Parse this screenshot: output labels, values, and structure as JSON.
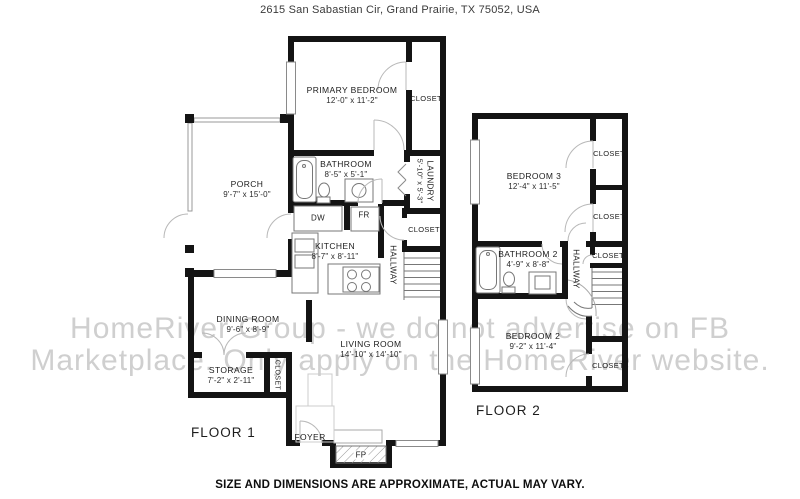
{
  "address": "2615 San Sabastian Cir, Grand Prairie, TX 75052, USA",
  "disclaimer": "SIZE AND DIMENSIONS ARE APPROXIMATE, ACTUAL MAY VARY.",
  "watermark": {
    "line1": "HomeRiver Group - we do not advertise on FB",
    "line2": "Marketplace. Only apply on the HomeRiver website."
  },
  "floor1": {
    "label": "FLOOR 1",
    "rooms": {
      "primary_bedroom": {
        "name": "PRIMARY BEDROOM",
        "dims": "12'-0\" x 11'-2\""
      },
      "primary_closet": {
        "name": "CLOSET"
      },
      "bathroom": {
        "name": "BATHROOM",
        "dims": "8'-5\" x 5'-1\""
      },
      "laundry": {
        "name": "LAUNDRY",
        "dims": "5'-10\" x 5'-3\""
      },
      "kitchen": {
        "name": "KITCHEN",
        "dims": "8'-7\" x 8'-11\""
      },
      "hallway": {
        "name": "HALLWAY"
      },
      "hall_closet": {
        "name": "CLOSET"
      },
      "porch": {
        "name": "PORCH",
        "dims": "9'-7\" x 15'-0\""
      },
      "dining_room": {
        "name": "DINING ROOM",
        "dims": "9'-6\" x 8'-9\""
      },
      "storage": {
        "name": "STORAGE",
        "dims": "7'-2\" x 2'-11\""
      },
      "storage_closet": {
        "name": "CLOSET"
      },
      "living_room": {
        "name": "LIVING ROOM",
        "dims": "14'-10\" x 14'-10\""
      },
      "foyer": {
        "name": "FOYER"
      }
    },
    "appliances": {
      "dishwasher": "DW",
      "fridge": "FR",
      "fireplace": "FP"
    }
  },
  "floor2": {
    "label": "FLOOR 2",
    "rooms": {
      "bedroom3": {
        "name": "BEDROOM 3",
        "dims": "12'-4\" x 11'-5\""
      },
      "closet_top": {
        "name": "CLOSET"
      },
      "closet_mid": {
        "name": "CLOSET"
      },
      "bathroom2": {
        "name": "BATHROOM 2",
        "dims": "4'-9\" x 8'-8\""
      },
      "hallway": {
        "name": "HALLWAY"
      },
      "closet_hall": {
        "name": "CLOSET"
      },
      "bedroom2": {
        "name": "BEDROOM 2",
        "dims": "9'-2\" x 11'-4\""
      },
      "closet_bedroom2": {
        "name": "CLOSET"
      }
    }
  }
}
